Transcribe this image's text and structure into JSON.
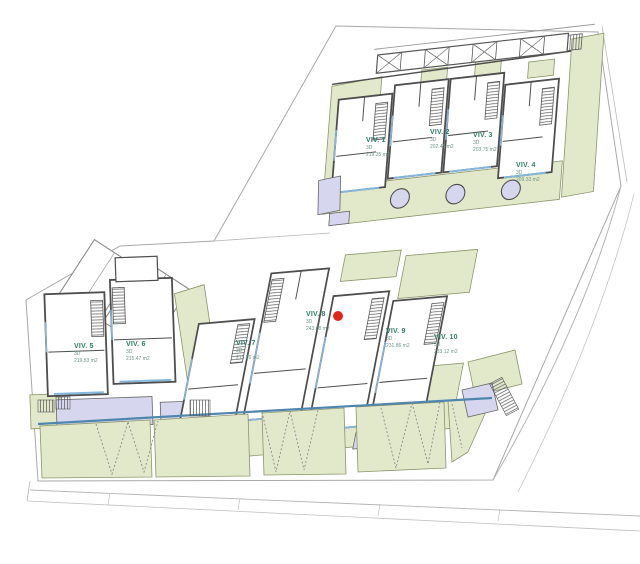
{
  "drawing": {
    "type": "residential-site-plan",
    "selected_unit": "VIV. 8"
  },
  "units": [
    {
      "name": "VIV. 1",
      "floors": "3D",
      "area": "219.35 m2"
    },
    {
      "name": "VIV. 2",
      "floors": "3D",
      "area": "202.45 m2"
    },
    {
      "name": "VIV. 3",
      "floors": "3D",
      "area": "203.75 m2"
    },
    {
      "name": "VIV. 4",
      "floors": "3D",
      "area": "209.33 m2"
    },
    {
      "name": "VIV. 5",
      "floors": "3D",
      "area": "219.53 m2"
    },
    {
      "name": "VIV. 6",
      "floors": "3D",
      "area": "215.47 m2"
    },
    {
      "name": "VIV. 7",
      "floors": "3D",
      "area": "213.26 m2"
    },
    {
      "name": "VIV. 8",
      "floors": "3D",
      "area": "243.68 m2"
    },
    {
      "name": "VIV. 9",
      "floors": "3D",
      "area": "231.86 m2"
    },
    {
      "name": "VIV. 10",
      "floors": "3D",
      "area": "233.12 m2"
    }
  ],
  "colors": {
    "garden_green": "#e2e9cb",
    "garden_stroke": "#8a9468",
    "lavender": "#d6d6ee",
    "wall": "#4d4d4d",
    "window_blue": "#85b7dc",
    "label_teal": "#2f7d68",
    "marker_red": "#e1251b",
    "boundary_gray": "#a8a8a8",
    "parking_line_blue": "#4f86ad"
  }
}
